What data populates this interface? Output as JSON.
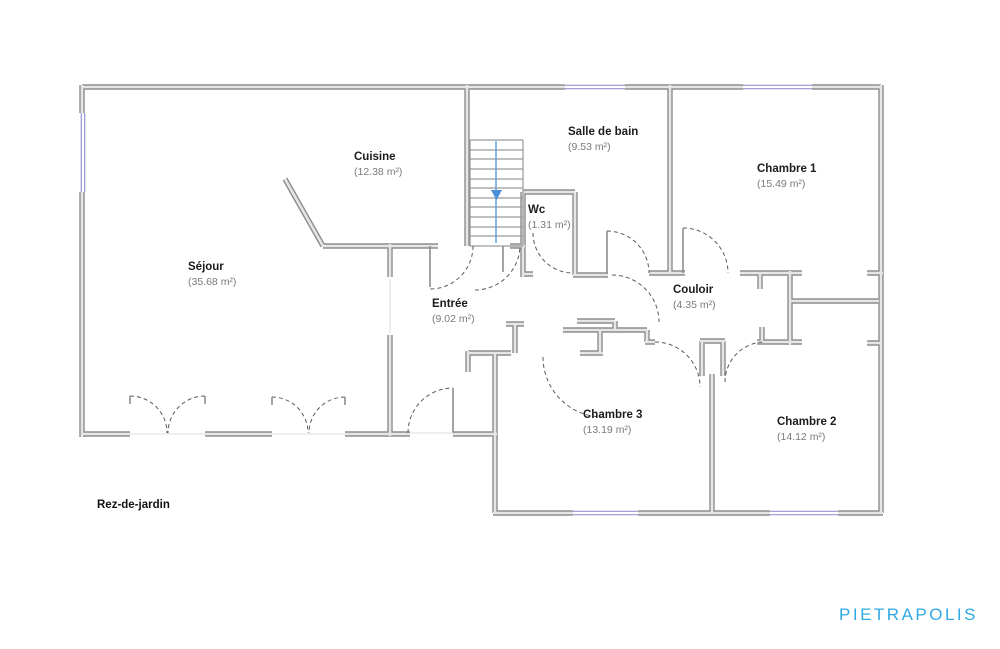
{
  "floor_label": "Rez-de-jardin",
  "brand": "PIETRAPOLIS",
  "rooms": [
    {
      "name": "Séjour",
      "area": "(35.68 m²)"
    },
    {
      "name": "Cuisine",
      "area": "(12.38 m²)"
    },
    {
      "name": "Salle de bain",
      "area": "(9.53 m²)"
    },
    {
      "name": "Wc",
      "area": "(1.31 m²)"
    },
    {
      "name": "Chambre 1",
      "area": "(15.49 m²)"
    },
    {
      "name": "Entrée",
      "area": "(9.02 m²)"
    },
    {
      "name": "Couloir",
      "area": "(4.35 m²)"
    },
    {
      "name": "Chambre 3",
      "area": "(13.19 m²)"
    },
    {
      "name": "Chambre 2",
      "area": "(14.12 m²)"
    }
  ],
  "colors": {
    "wall": "#8d8d8d",
    "wall_fill": "#e6e6e6",
    "window": "#9494d2",
    "stair_guide": "#5b9bd5",
    "brand_blue": "#2fa9e1",
    "room_name": "#1c1c1c",
    "room_area": "#7a7a7a"
  }
}
